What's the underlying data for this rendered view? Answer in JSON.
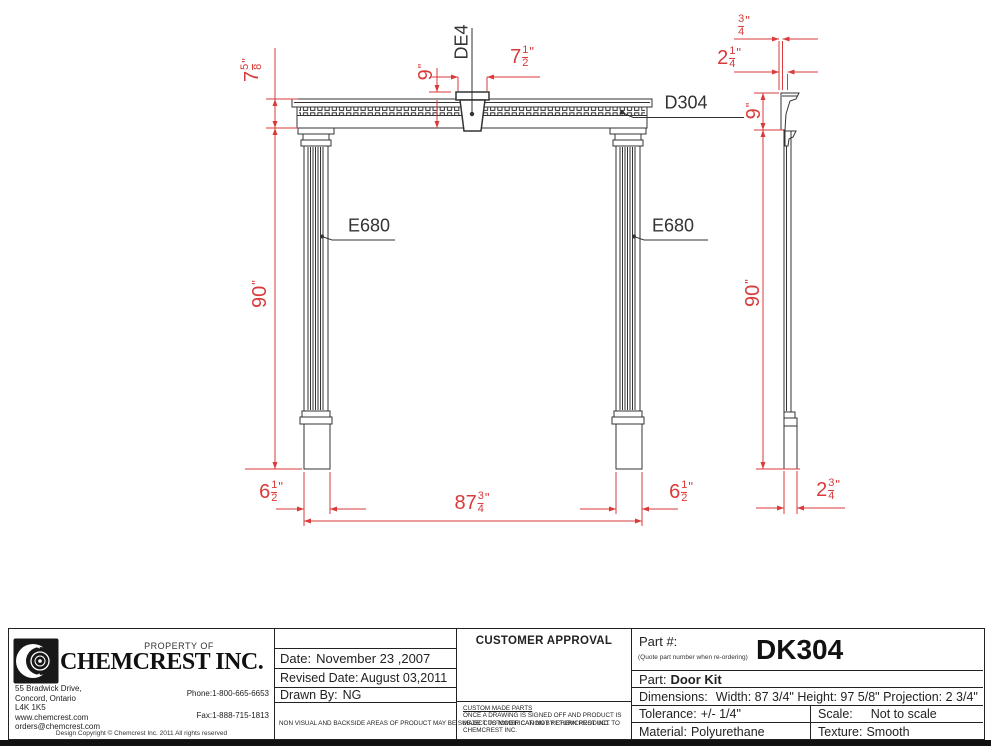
{
  "colors": {
    "dimension_red": "#d93a3a",
    "line_black": "#333333"
  },
  "drawing": {
    "labels": {
      "keystone": "DE4",
      "dentil_molding": "D304",
      "pilaster_left": "E680",
      "pilaster_right": "E680"
    },
    "dims": {
      "header_height": {
        "whole": "7",
        "num": "5",
        "den": "8",
        "unit": "\""
      },
      "keystone_height": {
        "whole": "9",
        "unit": "\""
      },
      "keystone_width": {
        "whole": "7",
        "num": "1",
        "den": "2",
        "unit": "\""
      },
      "side_top_offset": {
        "num": "3",
        "den": "4",
        "unit": "\""
      },
      "side_crown_projection": {
        "whole": "2",
        "num": "1",
        "den": "4",
        "unit": "\""
      },
      "side_header_height": {
        "whole": "9",
        "unit": "\""
      },
      "pilaster_height_front": {
        "whole": "90",
        "unit": "\""
      },
      "pilaster_height_side": {
        "whole": "90",
        "unit": "\""
      },
      "plinth_width_left": {
        "whole": "6",
        "num": "1",
        "den": "2",
        "unit": "\""
      },
      "overall_width": {
        "whole": "87",
        "num": "3",
        "den": "4",
        "unit": "\""
      },
      "plinth_width_right": {
        "whole": "6",
        "num": "1",
        "den": "2",
        "unit": "\""
      },
      "side_projection": {
        "whole": "2",
        "num": "3",
        "den": "4",
        "unit": "\""
      }
    }
  },
  "titleblock": {
    "company": {
      "property_of": "PROPERTY OF",
      "name": "CHEMCREST INC.",
      "address1": "55 Bradwick Drive,",
      "address2": "Concord, Ontario",
      "address3": "L4K 1K5",
      "web": "www.chemcrest.com",
      "email": "orders@chemcrest.com",
      "phone_label": "Phone:",
      "phone": "1-800-665-6653",
      "fax_label": "Fax:",
      "fax": "1-888-715-1813",
      "copyright": "Design Copyright © Chemcrest Inc. 2011 All rights reserved"
    },
    "dates": {
      "date_label": "Date:",
      "date": "November 23 ,2007",
      "revised_label": "Revised Date:",
      "revised": "August 03,2011",
      "drawn_label": "Drawn By:",
      "drawn": "NG",
      "note": "NON VISUAL AND BACKSIDE AREAS OF PRODUCT MAY BE SUBJECT TO MODIFICATION BY CHEMCREST INC."
    },
    "approval": {
      "title": "CUSTOMER APPROVAL",
      "note_title": "CUSTOM MADE PARTS",
      "note": "ONCE A DRAWING IS SIGNED OFF AND PRODUCT IS MADE CUSTOMER CAN NOT RETURN PRODUCT TO CHEMCREST INC."
    },
    "part": {
      "part_no_label": "Part #:",
      "part_no_hint": "(Quote part number when re-ordering)",
      "part_no": "DK304",
      "part_label": "Part:",
      "part_name": "Door Kit",
      "dimensions_label": "Dimensions:",
      "dimensions": "Width: 87 3/4\" Height: 97 5/8\"  Projection: 2 3/4\"",
      "tolerance_label": "Tolerance:",
      "tolerance": "+/- 1/4\"",
      "scale_label": "Scale:",
      "scale": "Not to scale",
      "material_label": "Material:",
      "material": "Polyurethane",
      "texture_label": "Texture:",
      "texture": "Smooth"
    }
  }
}
